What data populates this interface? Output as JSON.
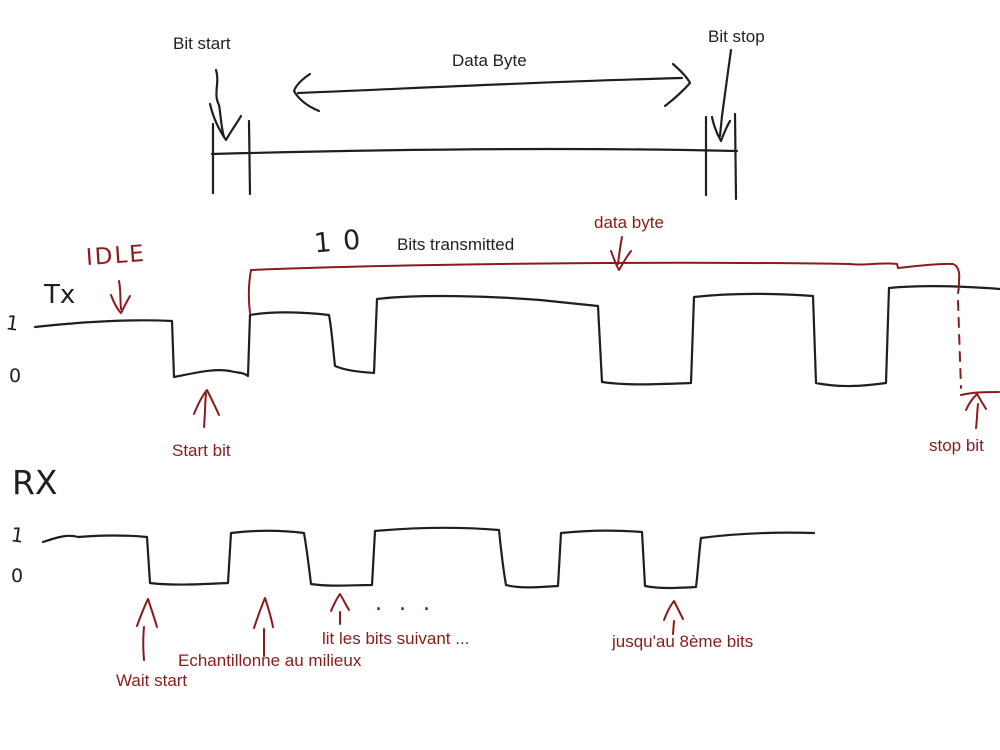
{
  "colors": {
    "ink": "#1f1f1f",
    "red": "#8a1b1b"
  },
  "top_diagram": {
    "bit_start_label": "Bit start",
    "data_byte_label": "Data Byte",
    "bit_stop_label": "Bit stop"
  },
  "tx_section": {
    "idle_label": "IDLE",
    "line_label": "Tx",
    "bits_count_handwritten": "10",
    "bits_transmitted_label": "Bits transmitted",
    "data_byte_label": "data byte",
    "start_bit_label": "Start bit",
    "stop_bit_label": "stop bit",
    "level_one": "1",
    "level_zero": "0"
  },
  "rx_section": {
    "line_label": "RX",
    "level_one": "1",
    "level_zero": "0",
    "wait_start_label": "Wait start",
    "sample_middle_label": "Echantillonne au milieux",
    "read_following_bits_label": "lit les bits suivant ...",
    "ellipsis_dots": ".  .  .",
    "until_eighth_bit_label": "jusqu'au 8ème bits"
  }
}
